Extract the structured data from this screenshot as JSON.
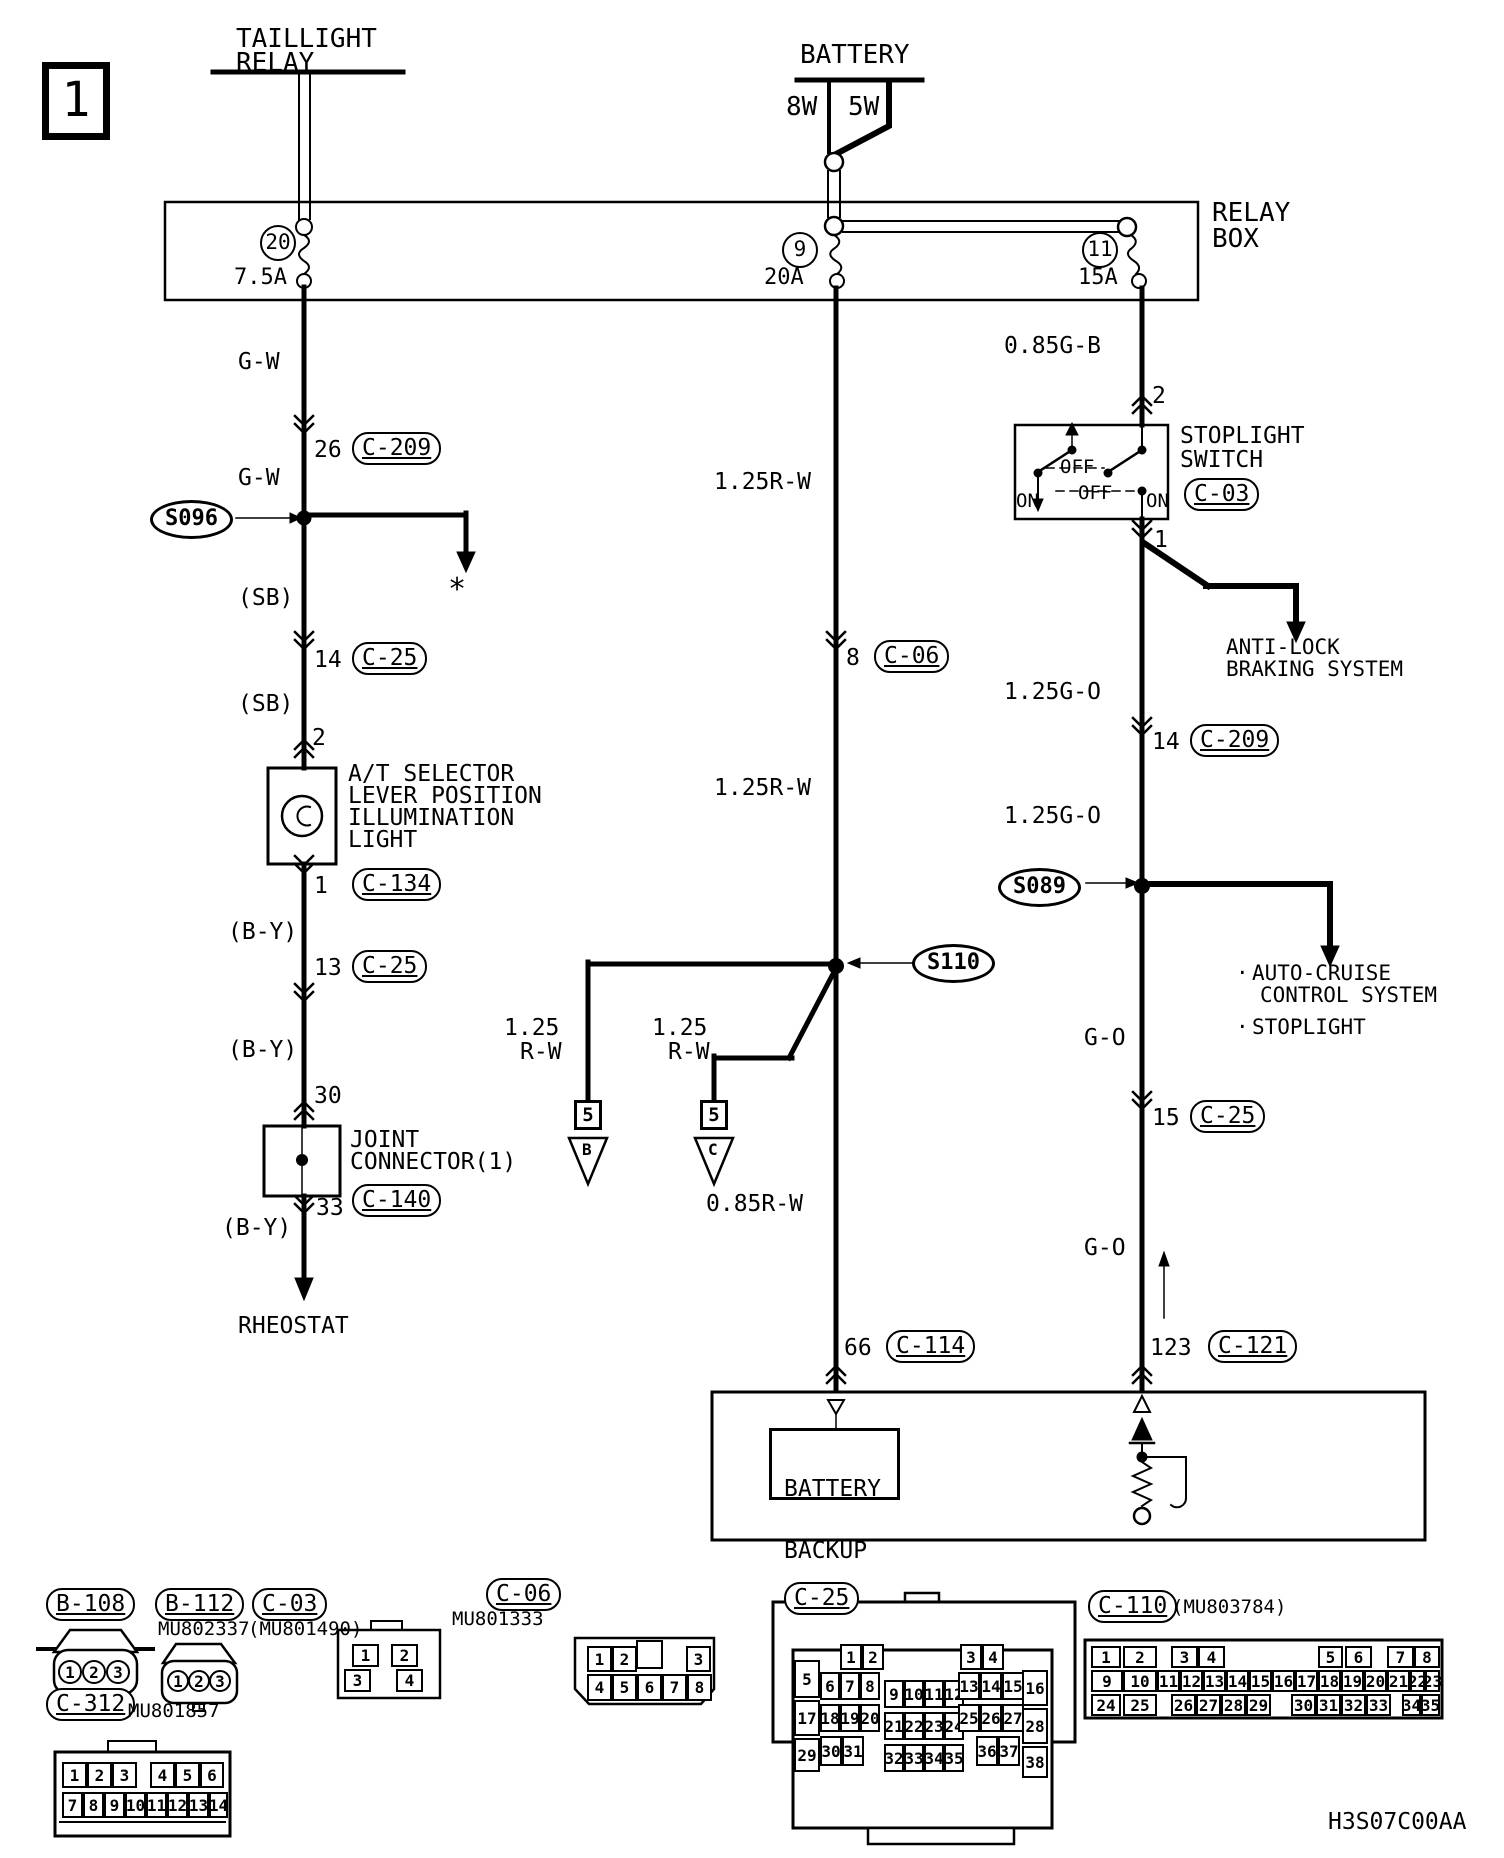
{
  "page": {
    "number": "1",
    "sheet_code": "H3S07C00AA"
  },
  "components": {
    "taillight_relay": [
      "TAILLIGHT",
      "RELAY"
    ],
    "battery": "BATTERY",
    "bulb_8w": "8W",
    "bulb_5w": "5W",
    "relay_box": [
      "RELAY",
      "BOX"
    ],
    "at_light": [
      "A/T SELECTOR",
      "LEVER POSITION",
      "ILLUMINATION",
      "LIGHT"
    ],
    "joint_connector": [
      "JOINT",
      "CONNECTOR(1)"
    ],
    "rheostat": "RHEOSTAT",
    "stoplight_switch": [
      "STOPLIGHT",
      "SWITCH"
    ],
    "switch_on_left": "ON",
    "switch_off_top": "OFF",
    "switch_off_bottom": "OFF",
    "switch_on_right": "ON",
    "abs_system": [
      "ANTI-LOCK",
      "BRAKING SYSTEM"
    ],
    "bullet1": "·",
    "bullet2": "·",
    "auto_cruise": [
      "AUTO-CRUISE",
      "CONTROL SYSTEM"
    ],
    "stoplight_dest": "STOPLIGHT",
    "battery_backup": [
      "BATTERY",
      "BACKUP"
    ]
  },
  "fuses": {
    "f20": {
      "num": "20",
      "amp": "7.5A"
    },
    "f9": {
      "num": "9",
      "amp": "20A"
    },
    "f11": {
      "num": "11",
      "amp": "15A"
    }
  },
  "splices": {
    "s096": "S096",
    "s110": "S110",
    "s089": "S089"
  },
  "footnote": "*",
  "wires": {
    "gw1": "G-W",
    "gw2": "G-W",
    "sb1": "(SB)",
    "sb2": "(SB)",
    "by1": "(B-Y)",
    "by2": "(B-Y)",
    "by3": "(B-Y)",
    "rw1": "1.25R-W",
    "rw2": "1.25R-W",
    "rw3": "0.85R-W",
    "rwb_size": "1.25",
    "rwb": "R-W",
    "rwc_size": "1.25",
    "rwc": "R-W",
    "gb": "0.85G-B",
    "go1": "1.25G-O",
    "go2": "1.25G-O",
    "go3": "G-O",
    "go4": "G-O"
  },
  "pins": {
    "p26": "26",
    "p14": "14",
    "p2": "2",
    "p1": "1",
    "p13": "13",
    "p30": "30",
    "p33": "33",
    "p8": "8",
    "p66": "66",
    "sw2": "2",
    "sw1": "1",
    "p14r": "14",
    "p15": "15",
    "p123": "123",
    "b5": "5",
    "c5": "5",
    "tri_b": "B",
    "tri_c": "C"
  },
  "refs": {
    "c209a": "C-209",
    "c25a": "C-25",
    "c134": "C-134",
    "c25b": "C-25",
    "c140": "C-140",
    "c06": "C-06",
    "c114": "C-114",
    "c209b": "C-209",
    "c25c": "C-25",
    "c121": "C-121",
    "c03": "C-03"
  },
  "connector_table": {
    "b108": {
      "name": "B-108"
    },
    "b112": {
      "name": "B-112",
      "part": "MU802337"
    },
    "c03": {
      "name": "C-03",
      "part": "(MU801490)"
    },
    "c312": {
      "name": "C-312",
      "part": "MU801857"
    },
    "c06": {
      "name": "C-06",
      "part": "MU801333"
    },
    "c25": {
      "name": "C-25"
    },
    "c110": {
      "name": "C-110",
      "part": "(MU803784)"
    }
  },
  "pin_grids": {
    "b108": {
      "circle": true,
      "cells": [
        {
          "n": "1",
          "x": 58,
          "y": 1660,
          "w": 24,
          "h": 24
        },
        {
          "n": "2",
          "x": 82,
          "y": 1660,
          "w": 24,
          "h": 24
        },
        {
          "n": "3",
          "x": 106,
          "y": 1660,
          "w": 24,
          "h": 24
        }
      ]
    },
    "b112": {
      "circle": true,
      "cells": [
        {
          "n": "1",
          "x": 167,
          "y": 1670,
          "w": 22,
          "h": 22
        },
        {
          "n": "2",
          "x": 188,
          "y": 1670,
          "w": 22,
          "h": 22
        },
        {
          "n": "3",
          "x": 209,
          "y": 1670,
          "w": 22,
          "h": 22
        }
      ]
    },
    "c03": {
      "cells": [
        {
          "n": "1",
          "x": 352,
          "y": 1644,
          "w": 27,
          "h": 23
        },
        {
          "n": "2",
          "x": 391,
          "y": 1644,
          "w": 27,
          "h": 23
        },
        {
          "n": "3",
          "x": 344,
          "y": 1669,
          "w": 27,
          "h": 23
        },
        {
          "n": "4",
          "x": 396,
          "y": 1669,
          "w": 27,
          "h": 23
        }
      ]
    },
    "c06": {
      "cells": [
        {
          "n": "1",
          "x": 587,
          "y": 1646,
          "w": 25,
          "h": 26
        },
        {
          "n": "2",
          "x": 612,
          "y": 1646,
          "w": 25,
          "h": 26
        },
        {
          "n": "3",
          "x": 686,
          "y": 1646,
          "w": 25,
          "h": 26
        },
        {
          "n": "4",
          "x": 587,
          "y": 1674,
          "w": 25,
          "h": 27
        },
        {
          "n": "5",
          "x": 612,
          "y": 1674,
          "w": 25,
          "h": 27
        },
        {
          "n": "6",
          "x": 637,
          "y": 1674,
          "w": 25,
          "h": 27
        },
        {
          "n": "7",
          "x": 662,
          "y": 1674,
          "w": 25,
          "h": 27
        },
        {
          "n": "8",
          "x": 687,
          "y": 1674,
          "w": 25,
          "h": 27
        }
      ]
    },
    "c25": {
      "cells": [
        {
          "n": "1",
          "x": 840,
          "y": 1644,
          "w": 22,
          "h": 26
        },
        {
          "n": "2",
          "x": 862,
          "y": 1644,
          "w": 22,
          "h": 26
        },
        {
          "n": "3",
          "x": 960,
          "y": 1644,
          "w": 22,
          "h": 26
        },
        {
          "n": "4",
          "x": 982,
          "y": 1644,
          "w": 22,
          "h": 26
        },
        {
          "n": "5",
          "x": 794,
          "y": 1660,
          "w": 26,
          "h": 38
        },
        {
          "n": "6",
          "x": 820,
          "y": 1672,
          "w": 20,
          "h": 28
        },
        {
          "n": "7",
          "x": 840,
          "y": 1672,
          "w": 20,
          "h": 28
        },
        {
          "n": "8",
          "x": 860,
          "y": 1672,
          "w": 20,
          "h": 28
        },
        {
          "n": "9",
          "x": 884,
          "y": 1680,
          "w": 20,
          "h": 28
        },
        {
          "n": "10",
          "x": 904,
          "y": 1680,
          "w": 20,
          "h": 28
        },
        {
          "n": "11",
          "x": 924,
          "y": 1680,
          "w": 20,
          "h": 28
        },
        {
          "n": "12",
          "x": 944,
          "y": 1680,
          "w": 20,
          "h": 28
        },
        {
          "n": "13",
          "x": 958,
          "y": 1672,
          "w": 22,
          "h": 28
        },
        {
          "n": "14",
          "x": 980,
          "y": 1672,
          "w": 22,
          "h": 28
        },
        {
          "n": "15",
          "x": 1002,
          "y": 1672,
          "w": 22,
          "h": 28
        },
        {
          "n": "16",
          "x": 1022,
          "y": 1670,
          "w": 26,
          "h": 36
        },
        {
          "n": "17",
          "x": 794,
          "y": 1700,
          "w": 26,
          "h": 36
        },
        {
          "n": "18",
          "x": 820,
          "y": 1704,
          "w": 20,
          "h": 28
        },
        {
          "n": "19",
          "x": 840,
          "y": 1704,
          "w": 20,
          "h": 28
        },
        {
          "n": "20",
          "x": 860,
          "y": 1704,
          "w": 20,
          "h": 28
        },
        {
          "n": "21",
          "x": 884,
          "y": 1712,
          "w": 20,
          "h": 28
        },
        {
          "n": "22",
          "x": 904,
          "y": 1712,
          "w": 20,
          "h": 28
        },
        {
          "n": "23",
          "x": 924,
          "y": 1712,
          "w": 20,
          "h": 28
        },
        {
          "n": "24",
          "x": 944,
          "y": 1712,
          "w": 20,
          "h": 28
        },
        {
          "n": "25",
          "x": 958,
          "y": 1704,
          "w": 22,
          "h": 28
        },
        {
          "n": "26",
          "x": 980,
          "y": 1704,
          "w": 22,
          "h": 28
        },
        {
          "n": "27",
          "x": 1002,
          "y": 1704,
          "w": 22,
          "h": 28
        },
        {
          "n": "28",
          "x": 1022,
          "y": 1708,
          "w": 26,
          "h": 36
        },
        {
          "n": "29",
          "x": 794,
          "y": 1738,
          "w": 26,
          "h": 34
        },
        {
          "n": "30",
          "x": 820,
          "y": 1736,
          "w": 22,
          "h": 30
        },
        {
          "n": "31",
          "x": 842,
          "y": 1736,
          "w": 22,
          "h": 30
        },
        {
          "n": "32",
          "x": 884,
          "y": 1744,
          "w": 20,
          "h": 28
        },
        {
          "n": "33",
          "x": 904,
          "y": 1744,
          "w": 20,
          "h": 28
        },
        {
          "n": "34",
          "x": 924,
          "y": 1744,
          "w": 20,
          "h": 28
        },
        {
          "n": "35",
          "x": 944,
          "y": 1744,
          "w": 20,
          "h": 28
        },
        {
          "n": "36",
          "x": 976,
          "y": 1736,
          "w": 22,
          "h": 30
        },
        {
          "n": "37",
          "x": 998,
          "y": 1736,
          "w": 22,
          "h": 30
        },
        {
          "n": "38",
          "x": 1022,
          "y": 1746,
          "w": 26,
          "h": 32
        }
      ]
    },
    "c110": {
      "cells": [
        {
          "n": "1",
          "x": 1091,
          "y": 1646,
          "w": 30,
          "h": 22
        },
        {
          "n": "2",
          "x": 1123,
          "y": 1646,
          "w": 34,
          "h": 22
        },
        {
          "n": "3",
          "x": 1171,
          "y": 1646,
          "w": 27,
          "h": 22
        },
        {
          "n": "4",
          "x": 1198,
          "y": 1646,
          "w": 27,
          "h": 22
        },
        {
          "n": "5",
          "x": 1318,
          "y": 1646,
          "w": 25,
          "h": 22
        },
        {
          "n": "6",
          "x": 1345,
          "y": 1646,
          "w": 27,
          "h": 22
        },
        {
          "n": "7",
          "x": 1387,
          "y": 1646,
          "w": 27,
          "h": 22
        },
        {
          "n": "8",
          "x": 1414,
          "y": 1646,
          "w": 26,
          "h": 22
        },
        {
          "n": "9",
          "x": 1091,
          "y": 1670,
          "w": 32,
          "h": 22
        },
        {
          "n": "10",
          "x": 1123,
          "y": 1670,
          "w": 34,
          "h": 22
        },
        {
          "n": "11",
          "x": 1157,
          "y": 1670,
          "w": 23,
          "h": 22
        },
        {
          "n": "12",
          "x": 1180,
          "y": 1670,
          "w": 23,
          "h": 22
        },
        {
          "n": "13",
          "x": 1203,
          "y": 1670,
          "w": 23,
          "h": 22
        },
        {
          "n": "14",
          "x": 1226,
          "y": 1670,
          "w": 23,
          "h": 22
        },
        {
          "n": "15",
          "x": 1249,
          "y": 1670,
          "w": 23,
          "h": 22
        },
        {
          "n": "16",
          "x": 1272,
          "y": 1670,
          "w": 23,
          "h": 22
        },
        {
          "n": "17",
          "x": 1295,
          "y": 1670,
          "w": 23,
          "h": 22
        },
        {
          "n": "18",
          "x": 1318,
          "y": 1670,
          "w": 23,
          "h": 22
        },
        {
          "n": "19",
          "x": 1341,
          "y": 1670,
          "w": 23,
          "h": 22
        },
        {
          "n": "20",
          "x": 1364,
          "y": 1670,
          "w": 23,
          "h": 22
        },
        {
          "n": "21",
          "x": 1387,
          "y": 1670,
          "w": 23,
          "h": 22
        },
        {
          "n": "22",
          "x": 1410,
          "y": 1670,
          "w": 15,
          "h": 22
        },
        {
          "n": "23",
          "x": 1425,
          "y": 1670,
          "w": 15,
          "h": 22
        },
        {
          "n": "24",
          "x": 1091,
          "y": 1694,
          "w": 30,
          "h": 22
        },
        {
          "n": "25",
          "x": 1123,
          "y": 1694,
          "w": 34,
          "h": 22
        },
        {
          "n": "26",
          "x": 1171,
          "y": 1694,
          "w": 25,
          "h": 22
        },
        {
          "n": "27",
          "x": 1196,
          "y": 1694,
          "w": 25,
          "h": 22
        },
        {
          "n": "28",
          "x": 1221,
          "y": 1694,
          "w": 25,
          "h": 22
        },
        {
          "n": "29",
          "x": 1246,
          "y": 1694,
          "w": 25,
          "h": 22
        },
        {
          "n": "30",
          "x": 1291,
          "y": 1694,
          "w": 25,
          "h": 22
        },
        {
          "n": "31",
          "x": 1316,
          "y": 1694,
          "w": 25,
          "h": 22
        },
        {
          "n": "32",
          "x": 1341,
          "y": 1694,
          "w": 25,
          "h": 22
        },
        {
          "n": "33",
          "x": 1366,
          "y": 1694,
          "w": 25,
          "h": 22
        },
        {
          "n": "34",
          "x": 1402,
          "y": 1694,
          "w": 19,
          "h": 22
        },
        {
          "n": "35",
          "x": 1421,
          "y": 1694,
          "w": 19,
          "h": 22
        }
      ]
    },
    "c312": {
      "cells": [
        {
          "n": "1",
          "x": 62,
          "y": 1762,
          "w": 25,
          "h": 26
        },
        {
          "n": "2",
          "x": 87,
          "y": 1762,
          "w": 25,
          "h": 26
        },
        {
          "n": "3",
          "x": 112,
          "y": 1762,
          "w": 25,
          "h": 26
        },
        {
          "n": "4",
          "x": 150,
          "y": 1762,
          "w": 25,
          "h": 26
        },
        {
          "n": "5",
          "x": 175,
          "y": 1762,
          "w": 25,
          "h": 26
        },
        {
          "n": "6",
          "x": 200,
          "y": 1762,
          "w": 24,
          "h": 26
        },
        {
          "n": "7",
          "x": 62,
          "y": 1792,
          "w": 21,
          "h": 26
        },
        {
          "n": "8",
          "x": 83,
          "y": 1792,
          "w": 21,
          "h": 26
        },
        {
          "n": "9",
          "x": 104,
          "y": 1792,
          "w": 21,
          "h": 26
        },
        {
          "n": "10",
          "x": 125,
          "y": 1792,
          "w": 21,
          "h": 26
        },
        {
          "n": "11",
          "x": 146,
          "y": 1792,
          "w": 21,
          "h": 26
        },
        {
          "n": "12",
          "x": 167,
          "y": 1792,
          "w": 21,
          "h": 26
        },
        {
          "n": "13",
          "x": 188,
          "y": 1792,
          "w": 21,
          "h": 26
        },
        {
          "n": "14",
          "x": 209,
          "y": 1792,
          "w": 19,
          "h": 26
        }
      ]
    }
  }
}
